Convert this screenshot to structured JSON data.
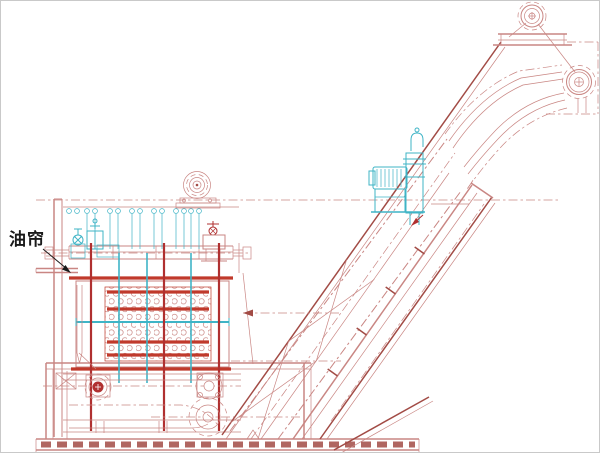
{
  "diagram": {
    "labels": {
      "oil_curtain": "油帘"
    },
    "colors": {
      "background": "#ffffff",
      "border": "#c9c9c9",
      "line": "#c98683",
      "line_dark": "#a24b45",
      "accent": "#c0392b",
      "accent_dark": "#b03030",
      "cyan": "#3fb4c6",
      "text": "#1a1a1a"
    }
  }
}
